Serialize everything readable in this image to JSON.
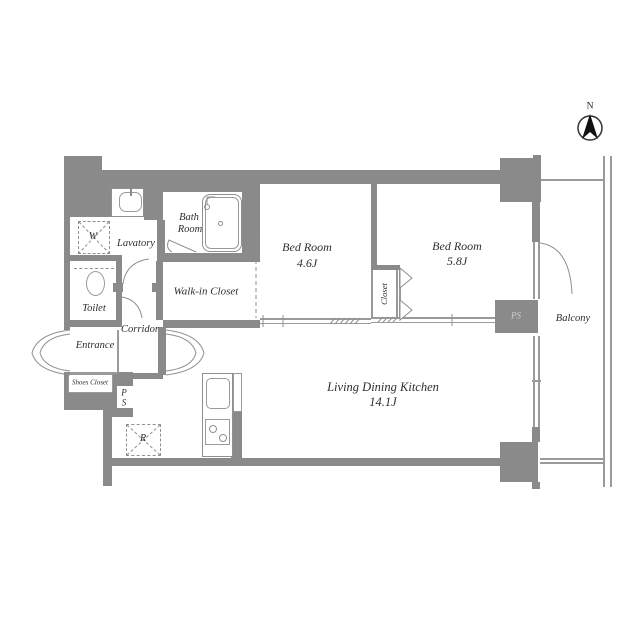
{
  "colors": {
    "wall": "#8a8a8a",
    "thin_line": "#9a9a9a",
    "text": "#2e2e2e"
  },
  "compass": {
    "north_label": "N"
  },
  "rooms": {
    "bath": {
      "line1": "Bath",
      "line2": "Room"
    },
    "lavatory": {
      "name": "Lavatory"
    },
    "toilet": {
      "name": "Toilet"
    },
    "entrance": {
      "name": "Entrance"
    },
    "corridor": {
      "name": "Corridor"
    },
    "shoes_closet": {
      "name": "Shoes Closet"
    },
    "walk_in_closet": {
      "name": "Walk-in Closet"
    },
    "bedroom_small": {
      "name": "Bed Room",
      "area": "4.6J"
    },
    "bedroom_large": {
      "name": "Bed Room",
      "area": "5.8J"
    },
    "closet": {
      "name": "Closet"
    },
    "ldk": {
      "name": "Living Dining Kitchen",
      "area": "14.1J"
    },
    "balcony": {
      "name": "Balcony"
    }
  },
  "fixtures": {
    "washer_label": "W",
    "refrigerator_label": "R",
    "pipe_space_right_label": "PS",
    "pipe_space_left": {
      "line1": "P",
      "line2": "S"
    }
  }
}
